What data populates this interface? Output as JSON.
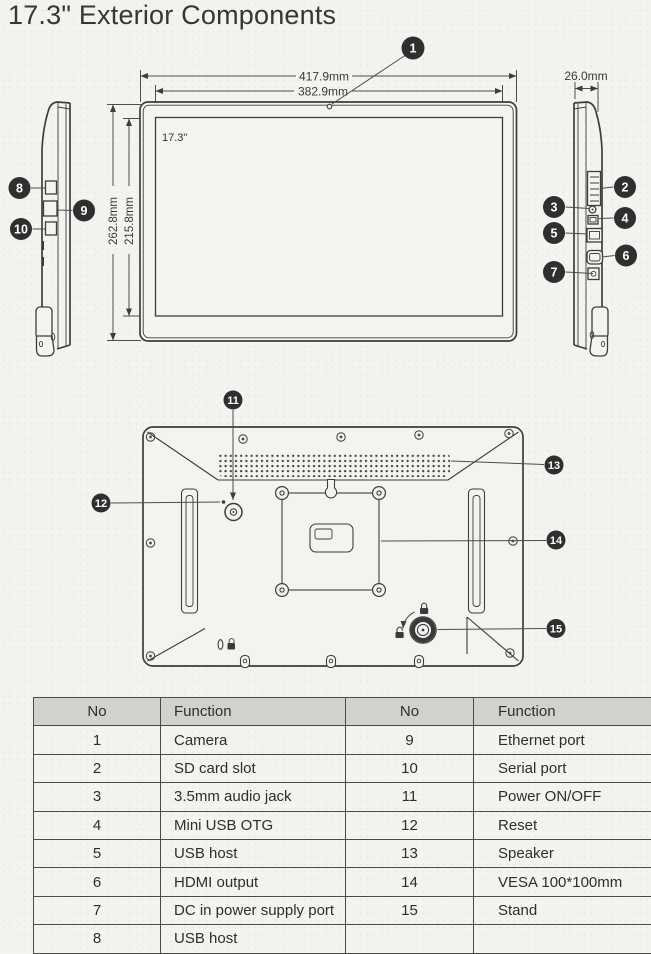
{
  "title": "17.3\" Exterior Components",
  "diagram": {
    "dimensions": {
      "outer_width": "417.9mm",
      "display_width": "382.9mm",
      "outer_height": "262.8mm",
      "display_height": "215.8mm",
      "side_depth": "26.0mm",
      "screen_size": "17.3\""
    },
    "callouts": [
      "1",
      "2",
      "3",
      "4",
      "5",
      "6",
      "7",
      "8",
      "9",
      "10",
      "11",
      "12",
      "13",
      "14",
      "15"
    ]
  },
  "table": {
    "header": {
      "no": "No",
      "function": "Function"
    },
    "left_rows": [
      {
        "no": "1",
        "function": "Camera"
      },
      {
        "no": "2",
        "function": "SD card slot"
      },
      {
        "no": "3",
        "function": "3.5mm audio jack"
      },
      {
        "no": "4",
        "function": "Mini USB OTG"
      },
      {
        "no": "5",
        "function": "USB host"
      },
      {
        "no": "6",
        "function": "HDMI output"
      },
      {
        "no": "7",
        "function": "DC in power supply port"
      },
      {
        "no": "8",
        "function": "USB host"
      }
    ],
    "right_rows": [
      {
        "no": "9",
        "function": "Ethernet port"
      },
      {
        "no": "10",
        "function": "Serial port"
      },
      {
        "no": "11",
        "function": "Power ON/OFF"
      },
      {
        "no": "12",
        "function": "Reset"
      },
      {
        "no": "13",
        "function": "Speaker"
      },
      {
        "no": "14",
        "function": "VESA 100*100mm"
      },
      {
        "no": "15",
        "function": "Stand"
      },
      {
        "no": "",
        "function": ""
      }
    ]
  }
}
